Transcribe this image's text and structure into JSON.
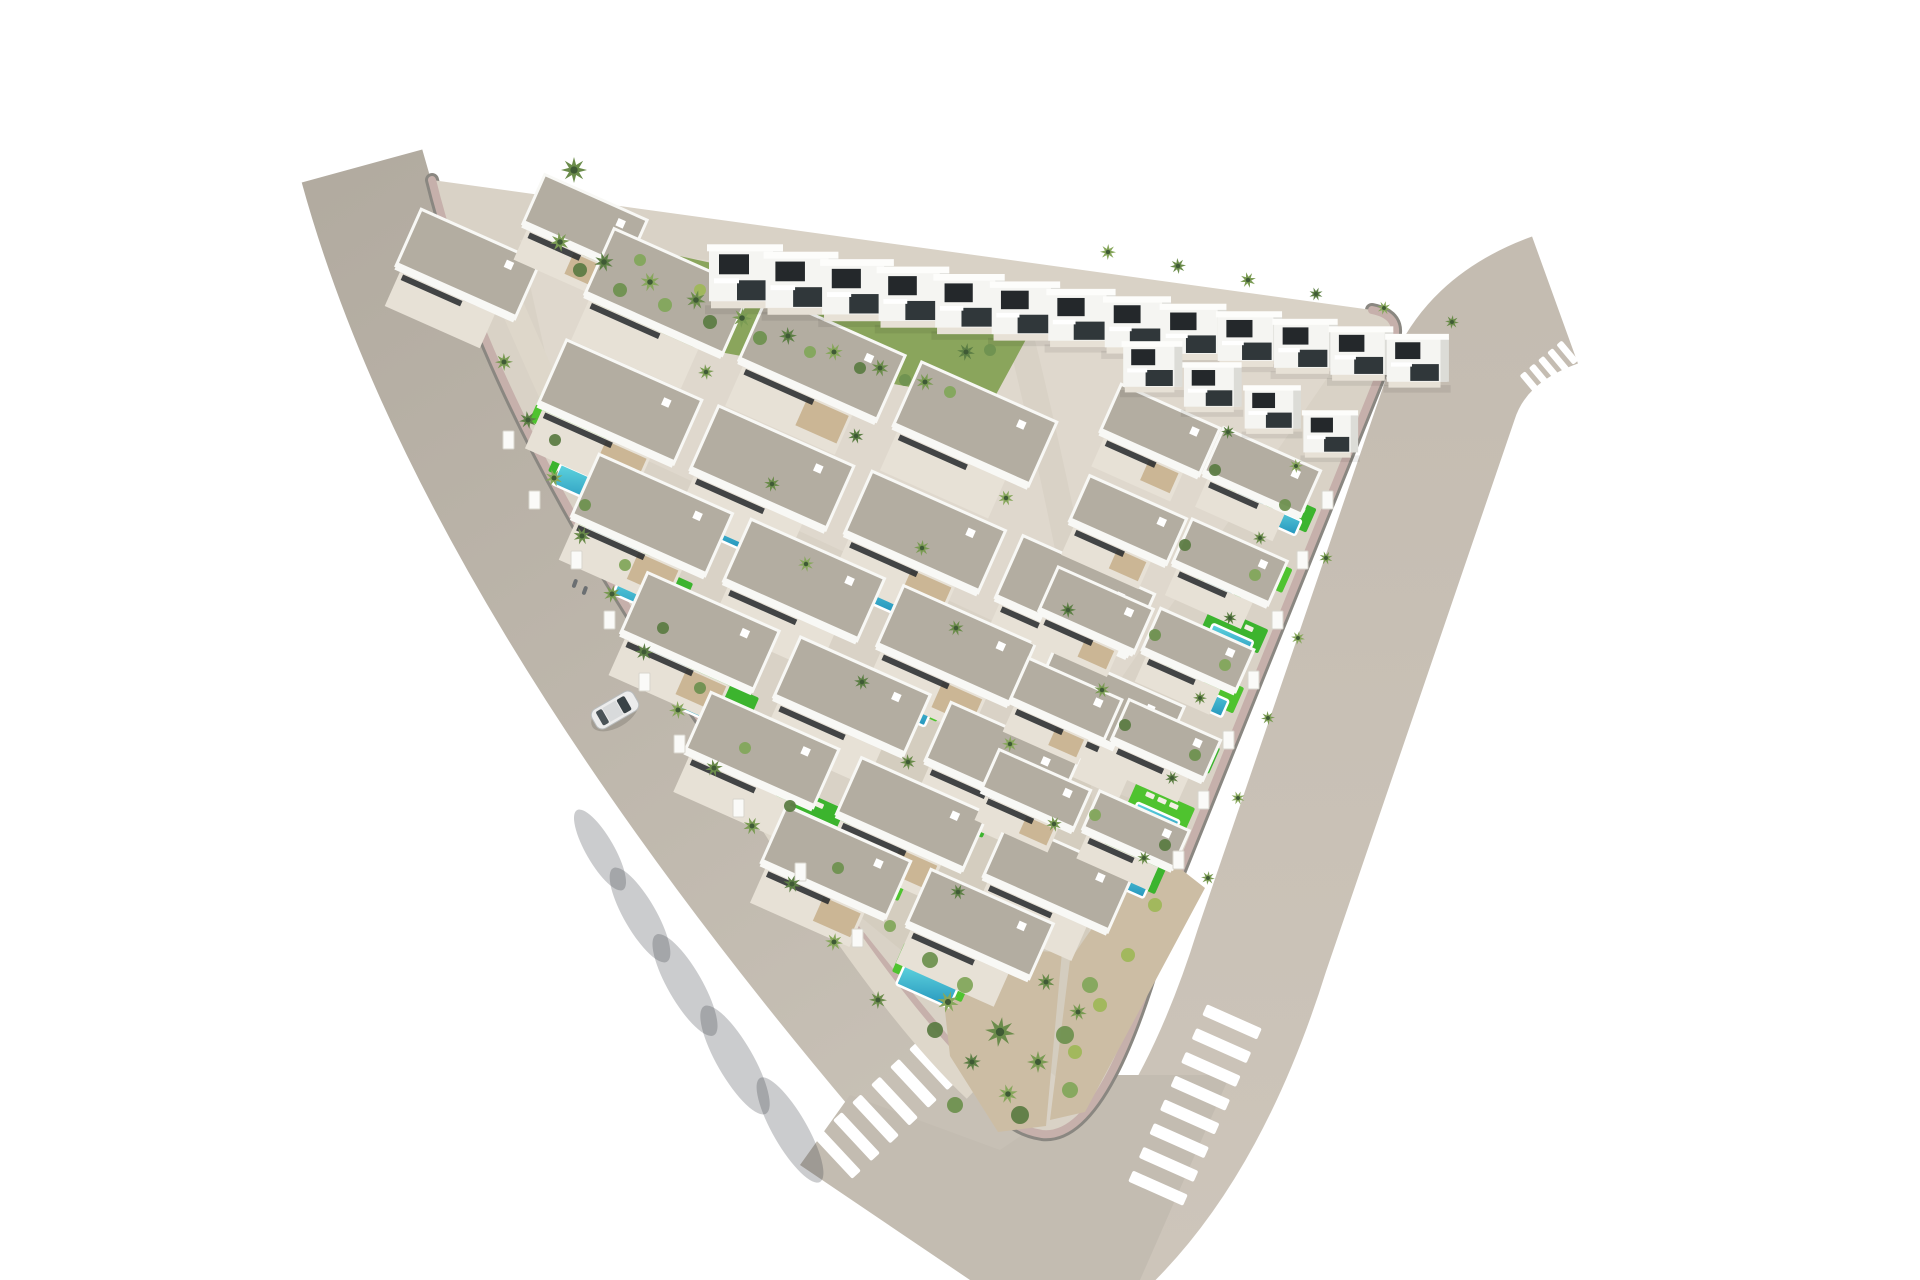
{
  "alt": "Aerial 3D architectural render of a white Mediterranean villa development on a triangular plot bounded by two curving roads, with private turquoise pools, bright green lawns, palm trees, zebra pedestrian crossings at the rounded bottom corner and a single white car driving on the left road.",
  "palette": {
    "background": "#ffffff",
    "road_left": "#b6afa5",
    "road_right": "#c8c0b5",
    "road_blend": "#c3bcb1",
    "sidewalk_pink": "#c6b0ab",
    "curb_dark": "#8a8781",
    "ground": "#d9d2c6",
    "ground_light": "#e6e0d5",
    "ground_dark": "#cdc5b5",
    "inner_path": "#ded7ca",
    "internal_street": "#d9d2c6",
    "roof_gravel": "#b3ada1",
    "roof_edge": "#f8f8f5",
    "villa_white": "#f5f5f2",
    "villa_side": "#dcdcd7",
    "villa_top": "#fdfdfb",
    "window_dark": "#24282b",
    "window_dark2": "#30373a",
    "terrace": "#e7e1d6",
    "pergola_wood": "#c8b18e",
    "pool_light": "#5fd4de",
    "pool_deep": "#2595bd",
    "pool_rim": "#ffffff",
    "lawn": "#3cb42e",
    "lawn_alt": "#4fc32f",
    "lounger": "#f3efe4",
    "slope_green": "#8aa55c",
    "dirt": "#ccbda4",
    "wall_white": "#fafaf8",
    "shadow": "rgba(55,58,66,0.26)",
    "palm_center": "#3f5a35",
    "palm_greens": [
      "#6b8c4b",
      "#7a9b53",
      "#5d7f45",
      "#87a75c"
    ],
    "bush_greens": [
      "#5d7c44",
      "#6f9150",
      "#83a75c",
      "#9fb75a"
    ],
    "car_body": "#ececec",
    "car_glass": "#3a4347",
    "car_roof": "#d8dadb",
    "car_rear": "#4a5357",
    "person": "#6b6f72"
  },
  "site": {
    "ground_path": "M 432,180 L 1372,310 Q 1402,316 1393,342 L 1176,880 Q 1112,1142 1042,1134 Q 1002,1128 982,1082 Q 520,540 432,180 Z",
    "curb_path": "M 1372,310 Q 1402,316 1393,342 L 1176,880 Q 1112,1142 1042,1134 Q 1002,1128 982,1082 Q 520,540 432,180",
    "inner_path_d": "M 505,290 Q 620,560 770,820 Q 890,1010 975,1090",
    "internal_street_d": "M 1022,342 Q 1075,560 1098,720 Q 1113,845 1100,952",
    "boundary_wall_d": "M 582,240 L 1038,336",
    "green_slope_points": "578,234 1030,332 992,402 600,330",
    "tip_garden_points": "938,948 1062,952 1046,1126 998,1132 950,1056",
    "dirt_strip_points": "1150,845 1205,888 1085,1112 1050,1120 1070,960",
    "patch_light_points": "520,240 1360,330 1120,680 560,420",
    "patch_dark_points": "880,700 1160,810 1060,1080 840,900"
  },
  "roads": {
    "left_d": "M 362,166 Q 470,560 900,1070 Q 990,1180 1060,1250",
    "left_width": 125,
    "right_d": "M 1555,300 Q 1472,330 1450,400 L 1262,950 Q 1195,1165 1075,1262",
    "right_width": 135,
    "blend_points": "850,1095 1000,1150 1110,1075 1230,1075 1140,1280 970,1280 800,1165",
    "wall_shadow_d": "M 486,206 Q 560,520 960,1066"
  },
  "row_angle_deg": 24,
  "top_edge": {
    "x0": 432,
    "y0": 180,
    "x1": 1372,
    "y1": 310
  },
  "villas_two_story_row1": [
    [
      745,
      1.0
    ],
    [
      801,
      0.985
    ],
    [
      857,
      0.97
    ],
    [
      913,
      0.955
    ],
    [
      969,
      0.94
    ],
    [
      1025,
      0.925
    ],
    [
      1081,
      0.91
    ],
    [
      1137,
      0.895
    ],
    [
      1193,
      0.88
    ],
    [
      1249,
      0.87
    ],
    [
      1305,
      0.86
    ],
    [
      1361,
      0.85
    ],
    [
      1417,
      0.84
    ]
  ],
  "villas_two_story_row2": [
    [
      1152,
      382,
      0.8
    ],
    [
      1212,
      402,
      0.78
    ],
    [
      1272,
      424,
      0.76
    ],
    [
      1330,
      448,
      0.74
    ]
  ],
  "villas_one_story": [
    [
      468,
      264,
      130,
      62
    ],
    [
      585,
      222,
      112,
      54
    ],
    [
      668,
      292,
      150,
      72
    ],
    [
      822,
      358,
      150,
      72
    ],
    [
      975,
      424,
      148,
      70
    ],
    [
      620,
      402,
      148,
      70
    ],
    [
      772,
      468,
      148,
      70
    ],
    [
      925,
      532,
      146,
      68
    ],
    [
      1075,
      596,
      144,
      68
    ],
    [
      652,
      515,
      146,
      68
    ],
    [
      804,
      580,
      146,
      68
    ],
    [
      956,
      645,
      144,
      66
    ],
    [
      1106,
      708,
      142,
      66
    ],
    [
      700,
      632,
      144,
      66
    ],
    [
      852,
      696,
      142,
      66
    ],
    [
      1002,
      760,
      140,
      64
    ],
    [
      762,
      750,
      140,
      64
    ],
    [
      912,
      814,
      138,
      62
    ],
    [
      1058,
      876,
      136,
      62
    ],
    [
      836,
      862,
      136,
      62
    ],
    [
      980,
      924,
      134,
      60
    ],
    [
      1160,
      430,
      108,
      52
    ],
    [
      1262,
      472,
      106,
      50
    ],
    [
      1128,
      520,
      106,
      50
    ],
    [
      1230,
      562,
      104,
      48
    ],
    [
      1096,
      610,
      104,
      48
    ],
    [
      1198,
      650,
      102,
      46
    ],
    [
      1066,
      700,
      102,
      46
    ],
    [
      1166,
      740,
      100,
      44
    ],
    [
      1036,
      790,
      100,
      44
    ],
    [
      1136,
      830,
      98,
      42
    ]
  ],
  "pools": [
    [
      565,
      436,
      60,
      22
    ],
    [
      584,
      486,
      60,
      22
    ],
    [
      614,
      540,
      60,
      22
    ],
    [
      645,
      596,
      60,
      22
    ],
    [
      676,
      652,
      62,
      22
    ],
    [
      710,
      710,
      62,
      22
    ],
    [
      748,
      768,
      62,
      22
    ],
    [
      806,
      826,
      62,
      22
    ],
    [
      862,
      884,
      62,
      22
    ],
    [
      717,
      528,
      56,
      20
    ],
    [
      870,
      592,
      56,
      20
    ],
    [
      1022,
      656,
      56,
      20
    ],
    [
      903,
      706,
      56,
      20
    ],
    [
      949,
      822,
      56,
      20
    ],
    [
      927,
      986,
      58,
      22
    ],
    [
      1280,
      520,
      40,
      16
    ],
    [
      1255,
      580,
      42,
      16
    ],
    [
      1230,
      640,
      44,
      16
    ],
    [
      1205,
      700,
      44,
      18
    ],
    [
      1180,
      760,
      46,
      18
    ],
    [
      1155,
      820,
      46,
      18
    ],
    [
      1125,
      880,
      48,
      18
    ],
    [
      1250,
      500,
      30,
      13
    ],
    [
      1218,
      590,
      30,
      13
    ],
    [
      1186,
      680,
      32,
      13
    ],
    [
      1154,
      770,
      32,
      13
    ]
  ],
  "palms": [
    [
      574,
      170,
      13
    ],
    [
      560,
      242,
      10
    ],
    [
      604,
      262,
      10
    ],
    [
      650,
      282,
      10
    ],
    [
      696,
      300,
      10
    ],
    [
      742,
      318,
      10
    ],
    [
      788,
      336,
      9
    ],
    [
      834,
      352,
      9
    ],
    [
      880,
      368,
      9
    ],
    [
      925,
      382,
      9
    ],
    [
      966,
      352,
      9
    ],
    [
      1108,
      252,
      8
    ],
    [
      1178,
      266,
      8
    ],
    [
      1248,
      280,
      8
    ],
    [
      1316,
      294,
      7
    ],
    [
      1384,
      308,
      7
    ],
    [
      1452,
      322,
      7
    ],
    [
      504,
      362,
      9
    ],
    [
      528,
      420,
      9
    ],
    [
      554,
      478,
      9
    ],
    [
      582,
      536,
      9
    ],
    [
      612,
      594,
      9
    ],
    [
      644,
      652,
      9
    ],
    [
      678,
      710,
      9
    ],
    [
      714,
      768,
      9
    ],
    [
      752,
      826,
      9
    ],
    [
      792,
      884,
      9
    ],
    [
      834,
      942,
      9
    ],
    [
      878,
      1000,
      9
    ],
    [
      706,
      372,
      8
    ],
    [
      856,
      436,
      8
    ],
    [
      1006,
      498,
      8
    ],
    [
      772,
      484,
      8
    ],
    [
      922,
      548,
      8
    ],
    [
      1068,
      610,
      8
    ],
    [
      806,
      564,
      8
    ],
    [
      956,
      628,
      8
    ],
    [
      1102,
      690,
      8
    ],
    [
      862,
      682,
      8
    ],
    [
      1010,
      744,
      8
    ],
    [
      908,
      762,
      8
    ],
    [
      1054,
      824,
      8
    ],
    [
      958,
      892,
      8
    ],
    [
      948,
      1002,
      11
    ],
    [
      1000,
      1032,
      15
    ],
    [
      1038,
      1062,
      11
    ],
    [
      972,
      1062,
      9
    ],
    [
      1008,
      1094,
      10
    ],
    [
      1046,
      982,
      9
    ],
    [
      1078,
      1012,
      9
    ],
    [
      1228,
      432,
      7
    ],
    [
      1296,
      466,
      7
    ],
    [
      1260,
      538,
      7
    ],
    [
      1326,
      558,
      7
    ],
    [
      1230,
      618,
      7
    ],
    [
      1298,
      638,
      7
    ],
    [
      1200,
      698,
      7
    ],
    [
      1268,
      718,
      7
    ],
    [
      1172,
      778,
      7
    ],
    [
      1238,
      798,
      7
    ],
    [
      1144,
      858,
      7
    ],
    [
      1208,
      878,
      7
    ]
  ],
  "bushes": [
    [
      580,
      270,
      7,
      0
    ],
    [
      620,
      290,
      7,
      1
    ],
    [
      665,
      305,
      7,
      2
    ],
    [
      710,
      322,
      7,
      0
    ],
    [
      760,
      338,
      7,
      1
    ],
    [
      810,
      352,
      6,
      2
    ],
    [
      860,
      368,
      6,
      0
    ],
    [
      905,
      380,
      6,
      1
    ],
    [
      950,
      392,
      6,
      2
    ],
    [
      990,
      350,
      6,
      1
    ],
    [
      700,
      290,
      6,
      3
    ],
    [
      640,
      260,
      6,
      2
    ],
    [
      555,
      440,
      6,
      0
    ],
    [
      585,
      505,
      6,
      1
    ],
    [
      625,
      565,
      6,
      2
    ],
    [
      663,
      628,
      6,
      0
    ],
    [
      700,
      688,
      6,
      1
    ],
    [
      745,
      748,
      6,
      2
    ],
    [
      790,
      806,
      6,
      0
    ],
    [
      838,
      868,
      6,
      1
    ],
    [
      890,
      926,
      6,
      2
    ],
    [
      930,
      960,
      8,
      1
    ],
    [
      965,
      985,
      8,
      2
    ],
    [
      935,
      1030,
      8,
      0
    ],
    [
      1065,
      1035,
      9,
      1
    ],
    [
      1090,
      985,
      8,
      2
    ],
    [
      955,
      1105,
      8,
      1
    ],
    [
      1020,
      1115,
      9,
      0
    ],
    [
      1070,
      1090,
      8,
      2
    ],
    [
      1155,
      905,
      7,
      3
    ],
    [
      1128,
      955,
      7,
      3
    ],
    [
      1100,
      1005,
      7,
      3
    ],
    [
      1075,
      1052,
      7,
      3
    ],
    [
      1215,
      470,
      6,
      0
    ],
    [
      1285,
      505,
      6,
      1
    ],
    [
      1255,
      575,
      6,
      2
    ],
    [
      1185,
      545,
      6,
      0
    ],
    [
      1155,
      635,
      6,
      1
    ],
    [
      1225,
      665,
      6,
      2
    ],
    [
      1125,
      725,
      6,
      0
    ],
    [
      1195,
      755,
      6,
      1
    ],
    [
      1095,
      815,
      6,
      2
    ],
    [
      1165,
      845,
      6,
      0
    ]
  ],
  "wall_pillars": [
    [
      508,
      440
    ],
    [
      534,
      500
    ],
    [
      576,
      560
    ],
    [
      609,
      620
    ],
    [
      644,
      682
    ],
    [
      679,
      744
    ],
    [
      738,
      808
    ],
    [
      800,
      872
    ],
    [
      857,
      938
    ],
    [
      1327,
      500
    ],
    [
      1302,
      560
    ],
    [
      1277,
      620
    ],
    [
      1253,
      680
    ],
    [
      1228,
      740
    ],
    [
      1203,
      800
    ],
    [
      1178,
      860
    ]
  ],
  "crosswalks": [
    {
      "x": 885,
      "y": 1110,
      "rot": 47,
      "n": 6,
      "len": 56,
      "th": 12,
      "gap": 26,
      "axis": "y"
    },
    {
      "x": 1195,
      "y": 1105,
      "rot": 24,
      "n": 8,
      "len": 60,
      "th": 12,
      "gap": 26,
      "axis": "y"
    },
    {
      "x": 1549,
      "y": 368,
      "rot": -40,
      "n": 5,
      "len": 26,
      "th": 7,
      "gap": 12,
      "axis": "x"
    }
  ],
  "car": {
    "x": 615,
    "y": 710,
    "rot": 60
  },
  "people": [
    [
      575,
      583
    ],
    [
      585,
      590
    ]
  ],
  "road_shadows": [
    [
      600,
      850,
      46,
      14
    ],
    [
      640,
      915,
      54,
      16
    ],
    [
      685,
      985,
      58,
      17
    ],
    [
      735,
      1060,
      62,
      18
    ],
    [
      790,
      1130,
      60,
      17
    ]
  ]
}
